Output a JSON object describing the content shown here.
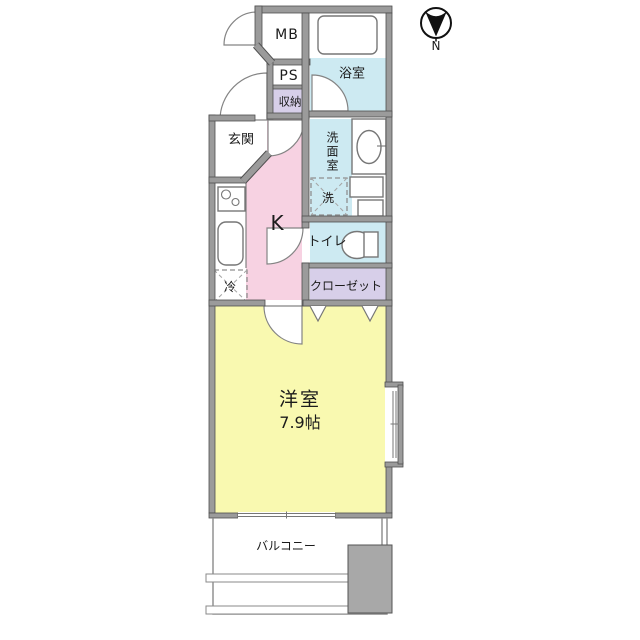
{
  "compass": {
    "north_label": "N"
  },
  "rooms": {
    "meter_box": {
      "label": "MB"
    },
    "bathroom": {
      "label": "浴室"
    },
    "pipe_space": {
      "label": "PS"
    },
    "storage": {
      "label": "収納"
    },
    "entrance": {
      "label": "玄関"
    },
    "washroom": {
      "label": "洗面室"
    },
    "washing_machine": {
      "label": "洗"
    },
    "kitchen": {
      "label": "K"
    },
    "toilet": {
      "label": "トイレ"
    },
    "refrigerator": {
      "label": "冷"
    },
    "closet": {
      "label": "クローゼット"
    },
    "western_room": {
      "label": "洋室",
      "size": "7.9帖"
    },
    "balcony": {
      "label": "バルコニー"
    }
  },
  "colors": {
    "room_yellow": "#f9f9b0",
    "room_pink": "#f7d2e2",
    "room_blue": "#cdeaf2",
    "room_purple": "#d7cfe9",
    "wall_gray": "#9b9b9b",
    "wall_outline": "#4f4f4f",
    "fixture_line": "#777777",
    "balcony_gray": "#a8a8a8"
  }
}
